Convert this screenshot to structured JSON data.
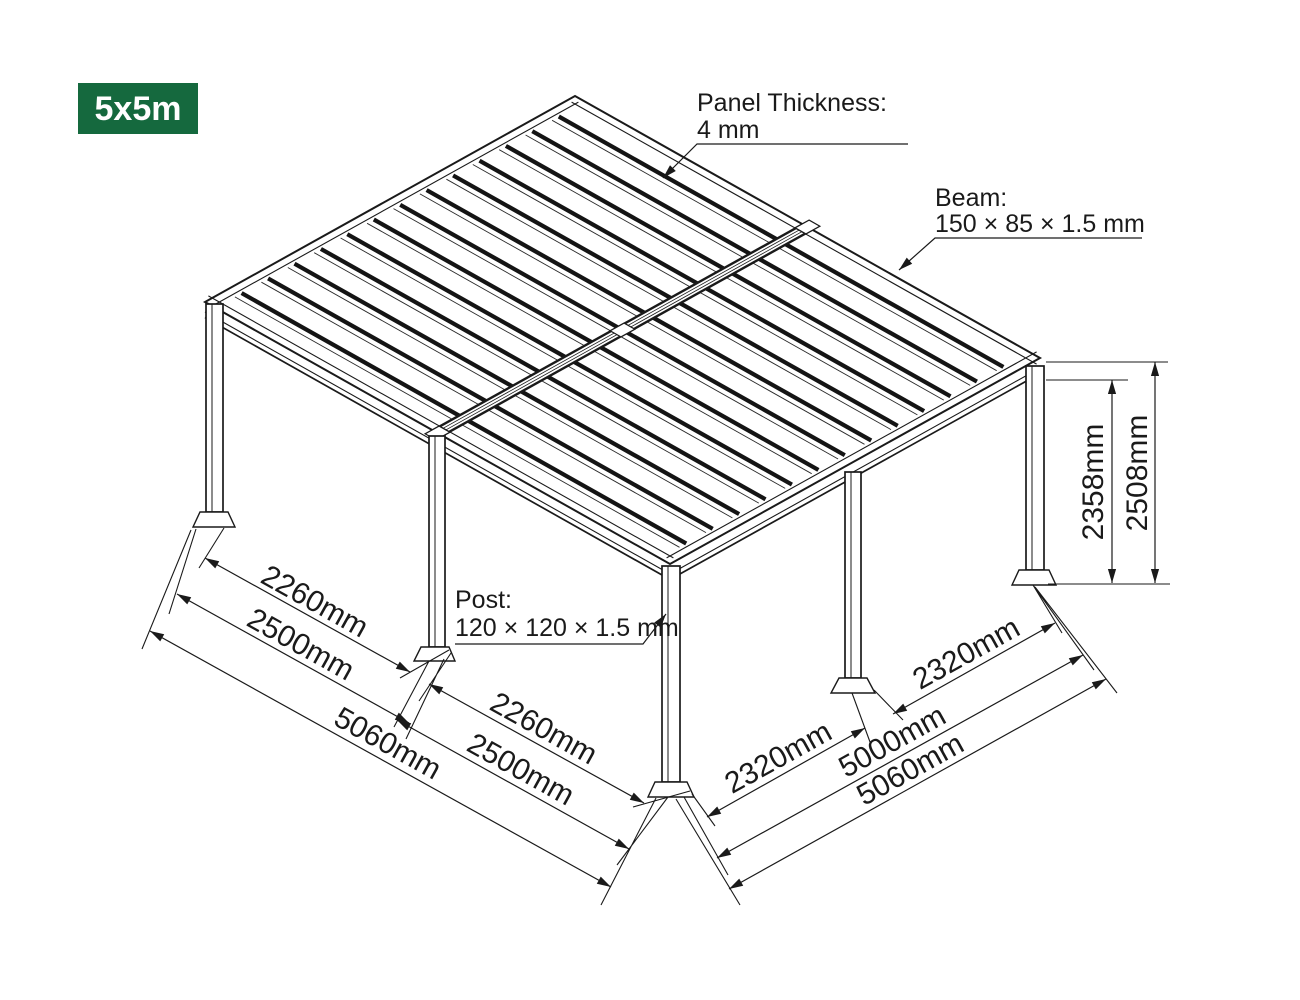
{
  "badge": {
    "label": "5x5m",
    "bg_color": "#15693E",
    "text_color": "#ffffff"
  },
  "callouts": {
    "panel": {
      "title": "Panel Thickness:",
      "value": "4 mm"
    },
    "beam": {
      "title": "Beam:",
      "value": "150 × 85 × 1.5 mm"
    },
    "post": {
      "title": "Post:",
      "value": "120 × 120 × 1.5 mm"
    }
  },
  "dimensions": {
    "left": {
      "inner": "2260mm",
      "bay": "2500mm",
      "overall": "5060mm"
    },
    "middle": {
      "inner": "2260mm",
      "bay": "2500mm"
    },
    "right": {
      "inner_front": "2320mm",
      "inner_back": "2320mm",
      "total": "5000mm",
      "overall": "5060mm"
    },
    "height": {
      "post": "2358mm",
      "overall": "2508mm"
    }
  },
  "line_color": "#1a1a1a"
}
